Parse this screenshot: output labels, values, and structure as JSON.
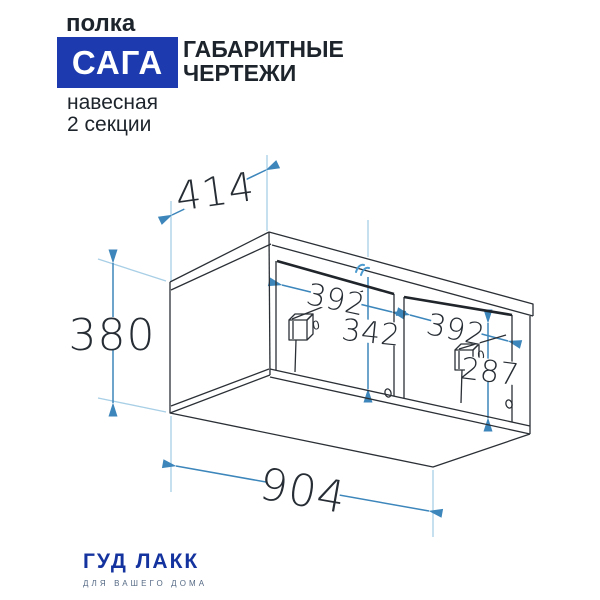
{
  "header": {
    "category": "полка",
    "badge": "САГА",
    "title_line1": "ГАБАРИТНЫЕ",
    "title_line2": "ЧЕРТЕЖИ",
    "subtitle_line1": "навесная",
    "subtitle_line2": "2 секции"
  },
  "drawing": {
    "type": "isometric dimensional drawing of wall shelf, 2 sections",
    "dim_depth": "414",
    "dim_height": "380",
    "dim_width": "904",
    "dim_section1_width": "392",
    "dim_section2_width": "392",
    "dim_section1_height": "342",
    "dim_section2_height": "287",
    "bracket_label": "0"
  },
  "footer": {
    "brand": "ГУД ЛАКК",
    "tagline": "ДЛЯ ВАШЕГО ДОМА"
  },
  "colors": {
    "badge_bg": "#1d3bae",
    "badge_text": "#ffffff",
    "heading_text": "#1d242b",
    "brand_blue": "#14339e",
    "tagline_gray": "#566a85",
    "dimension_blue": "#3c86bb",
    "extension_blue": "#a8cfe6",
    "line_dark": "#2b3036"
  }
}
